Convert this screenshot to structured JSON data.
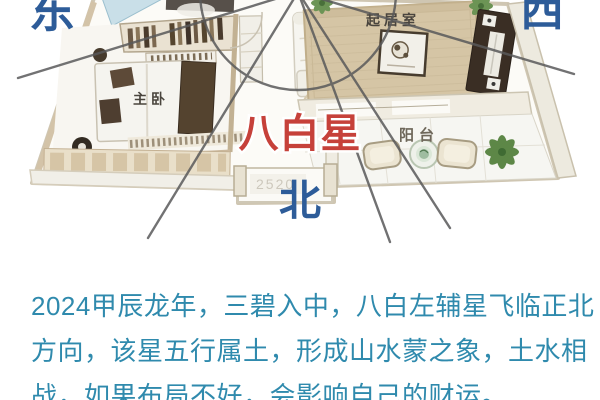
{
  "image": {
    "description_labels": {
      "east": "东",
      "west": "西",
      "north": "北"
    },
    "directions": {
      "east": "东",
      "west": "西",
      "north": "北"
    },
    "direction_color": "#2d5c99",
    "star_label": {
      "text": "八白星",
      "color": "#c6413a",
      "outline_color": "#ffffff"
    },
    "rooms": {
      "master_bedroom": "主卧",
      "living_room": "起居室",
      "balcony": "阳台"
    },
    "room_label_color": "#4a453e",
    "balcony_label_color": "#6e675a",
    "door_dimension": "2520",
    "compass_line_color": "#59595a"
  },
  "article": {
    "text_color": "#2f8aad",
    "lines": [
      "2024甲辰龙年，三碧入中，八白左辅星飞临正北",
      "方向，该星五行属土，形成山水蒙之象，土水相",
      "战，如果布局不好，会影响自己的财运。"
    ]
  }
}
